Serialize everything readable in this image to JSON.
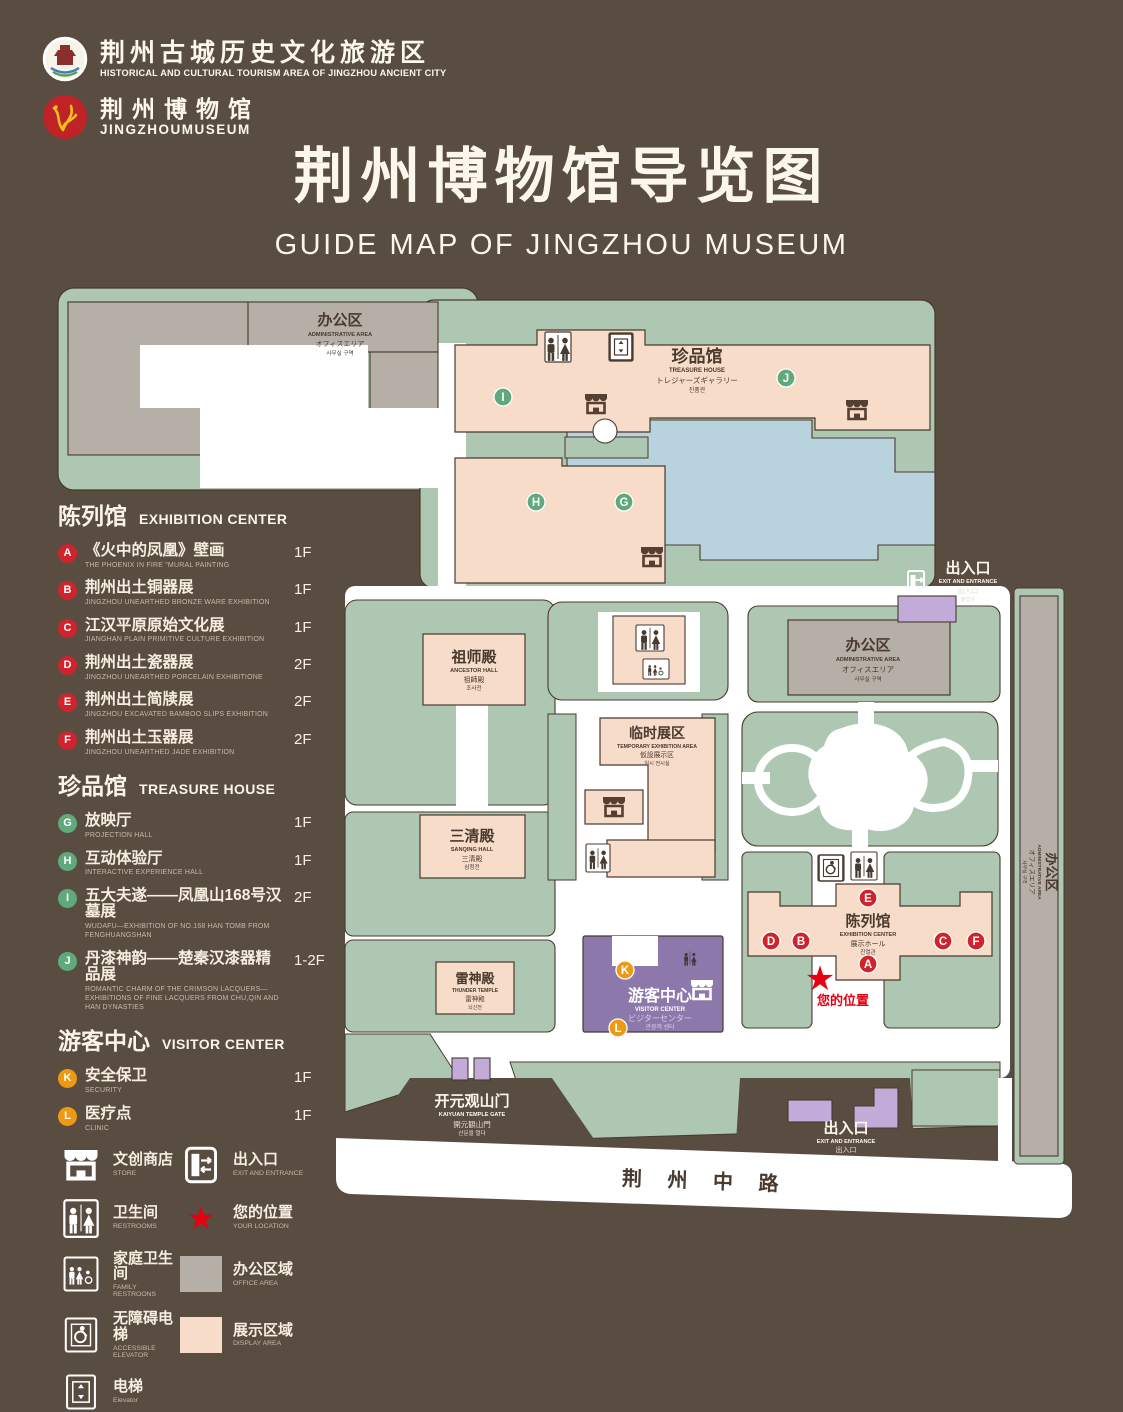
{
  "header": {
    "logo1": {
      "cn": "荆州古城历史文化旅游区",
      "en": "HISTORICAL AND CULTURAL TOURISM AREA OF JINGZHOU ANCIENT CITY"
    },
    "logo2": {
      "cn": "荆州博物馆",
      "en": "JINGZHOUMUSEUM"
    },
    "title_cn": "荆州博物馆导览图",
    "title_en": "GUIDE MAP OF JINGZHOU MUSEUM"
  },
  "legend": {
    "sections": [
      {
        "title_cn": "陈列馆",
        "title_en": "EXHIBITION CENTER",
        "items": [
          {
            "letter": "A",
            "cn": "《火中的凤凰》壁画",
            "en": "THE PHOENIX IN FIRE \"MURAL PAINTING",
            "floor": "1F"
          },
          {
            "letter": "B",
            "cn": "荆州出土铜器展",
            "en": "JINGZHOU UNEARTHED BRONZE WARE EXHIBITION",
            "floor": "1F"
          },
          {
            "letter": "C",
            "cn": "江汉平原原始文化展",
            "en": "JIANGHAN PLAIN PRIMITIVE CULTURE EXHIBITION",
            "floor": "1F"
          },
          {
            "letter": "D",
            "cn": "荆州出土瓷器展",
            "en": "JINGZHOU UNEARTHED PORCELAIN EXHIBITIONE",
            "floor": "2F"
          },
          {
            "letter": "E",
            "cn": "荆州出土简牍展",
            "en": "JINGZHOU EXCAVATED BAMBOO SLIPS EXHIBITION",
            "floor": "2F"
          },
          {
            "letter": "F",
            "cn": "荆州出土玉器展",
            "en": "JINGZHOU UNEARTHED JADE EXHIBITION",
            "floor": "2F"
          }
        ]
      },
      {
        "title_cn": "珍品馆",
        "title_en": "TREASURE HOUSE",
        "items": [
          {
            "letter": "G",
            "cn": "放映厅",
            "en": "PROJECTION HALL",
            "floor": "1F"
          },
          {
            "letter": "H",
            "cn": "互动体验厅",
            "en": "INTERACTIVE EXPERIENCE HALL",
            "floor": "1F"
          },
          {
            "letter": "I",
            "cn": "五大夫遂——凤凰山168号汉墓展",
            "en": "WUDAFU—EXHIBITION OF NO.168 HAN TOMB FROM FENGHUANGSHAN",
            "floor": "2F"
          },
          {
            "letter": "J",
            "cn": "丹漆神韵——楚秦汉漆器精品展",
            "en": "ROMANTIC CHARM OF THE CRIMSON LACQUERS—EXHIBITIONS OF FINE LACQUERS FROM CHU,QIN AND HAN DYNASTIES",
            "floor": "1-2F"
          }
        ]
      },
      {
        "title_cn": "游客中心",
        "title_en": "VISITOR CENTER",
        "items": [
          {
            "letter": "K",
            "cn": "安全保卫",
            "en": "SECURITY",
            "floor": "1F"
          },
          {
            "letter": "L",
            "cn": "医疗点",
            "en": "CLINIC",
            "floor": "1F"
          }
        ]
      }
    ],
    "symbols": [
      {
        "icon": "store-icon",
        "cn": "文创商店",
        "en": "STORE"
      },
      {
        "icon": "exit-icon",
        "cn": "出入口",
        "en": "EXIT AND ENTRANCE"
      },
      {
        "icon": "restroom-icon",
        "cn": "卫生间",
        "en": "RESTROOMS"
      },
      {
        "icon": "location-star-icon",
        "cn": "您的位置",
        "en": "YOUR LOCATION",
        "star": "★"
      },
      {
        "icon": "family-restroom-icon",
        "cn": "家庭卫生间",
        "en": "FAMILY RESTROONS"
      },
      {
        "icon": "office-swatch",
        "cn": "办公区域",
        "en": "OFFICE AREA"
      },
      {
        "icon": "accessible-elevator-icon",
        "cn": "无障碍电梯",
        "en": "ACCESSIBLE ELEVATOR"
      },
      {
        "icon": "display-swatch",
        "cn": "展示区域",
        "en": "DISPLAY AREA"
      },
      {
        "icon": "elevator-icon",
        "cn": "电梯",
        "en": "Elevator"
      }
    ]
  },
  "map": {
    "areas": {
      "admin_nw": {
        "cn": "办公区",
        "en": "ADMINISTRATIVE AREA",
        "jp": "オフィスエリア",
        "kr": "사무실 구역"
      },
      "treasure": {
        "cn": "珍品馆",
        "en": "TREASURE HOUSE",
        "jp": "トレジャーズギャラリー",
        "kr": "진품관"
      },
      "exit_ne": {
        "cn": "出入口",
        "en": "EXIT AND ENTRANCE",
        "jp": "出入口",
        "kr": "출입구"
      },
      "admin_e": {
        "cn": "办公区",
        "en": "ADMINISTRATIVE AREA",
        "jp": "オフィスエリア",
        "kr": "사무실 구역"
      },
      "admin_se": {
        "cn": "办公区",
        "en": "ADMINISTRATIVE AREA",
        "jp": "オフィスエリア",
        "kr": "사무실 구역"
      },
      "ancestor": {
        "cn": "祖师殿",
        "en": "ANCESTOR HALL",
        "jp": "祖師殿",
        "kr": "조사전"
      },
      "temporary": {
        "cn": "临时展区",
        "en": "TEMPORARY EXHIBITION AREA",
        "jp": "仮設展示区",
        "kr": "임시 전시실"
      },
      "sanqing": {
        "cn": "三清殿",
        "en": "SANQING HALL",
        "jp": "三清殿",
        "kr": "삼청전"
      },
      "thunder": {
        "cn": "雷神殿",
        "en": "THUNDER TEMPLE",
        "jp": "雷神殿",
        "kr": "뇌신전"
      },
      "visitor": {
        "cn": "游客中心",
        "en": "VISITOR CENTER",
        "jp": "ビジターセンター",
        "kr": "관광객 센터"
      },
      "exhibition": {
        "cn": "陈列馆",
        "en": "EXHIBITION CENTER",
        "jp": "展示ホール",
        "kr": "진열관"
      },
      "gate": {
        "cn": "开元观山门",
        "en": "KAIYUAN TEMPLE GATE",
        "jp": "開元観山門",
        "kr": "산문을 열다"
      },
      "exit_s": {
        "cn": "出入口",
        "en": "EXIT AND ENTRANCE",
        "jp": "出入口",
        "kr": "출입구"
      }
    },
    "road": "荆 州 中 路",
    "your_location": "您的位置"
  },
  "palette": {
    "background": "#594c41",
    "grounds_green": "#aec7b2",
    "display_pink": "#f8dcca",
    "office_gray": "#b6afa7",
    "pond_blue": "#b9d3de",
    "visitor_purple": "#8d78ab",
    "gate_lavender": "#c2abd8",
    "road_white": "#ffffff",
    "marker_red": "#cf242d",
    "marker_green": "#5fa97c",
    "marker_orange": "#ee9914",
    "star_red": "#e60012",
    "outline_brown": "#483a2e"
  }
}
